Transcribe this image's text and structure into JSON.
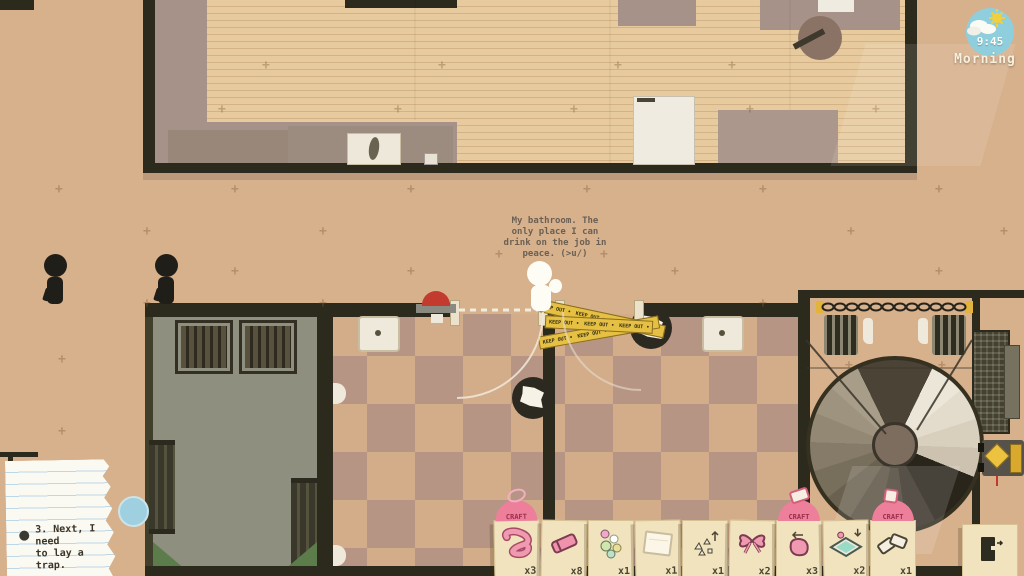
{
  "hud": {
    "clock": {
      "time": "9:45",
      "period": "Morning"
    },
    "thought": "My bathroom. The\nonly place I can\ndrink on the job in\npeace. (>u/)",
    "note_text": "3. Next, I need\nto lay a trap.",
    "craft_label": "CRAFT",
    "tape_text": "KEEP OUT",
    "hotbar": {
      "items": [
        {
          "name": "rubber-tube",
          "icon": "rubber-tube-icon",
          "qty": "x3",
          "craftable": true
        },
        {
          "name": "eraser",
          "icon": "eraser-icon",
          "qty": "x8",
          "craftable": false
        },
        {
          "name": "marbles",
          "icon": "marbles-icon",
          "qty": "x1",
          "craftable": false
        },
        {
          "name": "paper-sheet",
          "icon": "paper-sheet-icon",
          "qty": "x1",
          "craftable": false
        },
        {
          "name": "tacks",
          "icon": "tacks-icon",
          "qty": "x1",
          "craftable": false
        },
        {
          "name": "ribbon-bow",
          "icon": "ribbon-bow-icon",
          "qty": "x2",
          "craftable": false
        },
        {
          "name": "pouch",
          "icon": "pouch-icon",
          "qty": "x3",
          "craftable": true
        },
        {
          "name": "liquid-tray",
          "icon": "liquid-tray-icon",
          "qty": "x2",
          "craftable": false
        },
        {
          "name": "dominoes",
          "icon": "dominoes-icon",
          "qty": "x1",
          "craftable": true
        }
      ]
    }
  },
  "colors": {
    "floor_tan": "#d7b08c",
    "checker_dark": "#b79584",
    "wall_dark": "#2b2a1c",
    "tape_yellow": "#e5c043",
    "craft_pink": "#ee7f9b",
    "clock_blue": "#8fcfdd",
    "card_cream": "#f0e3bd"
  }
}
